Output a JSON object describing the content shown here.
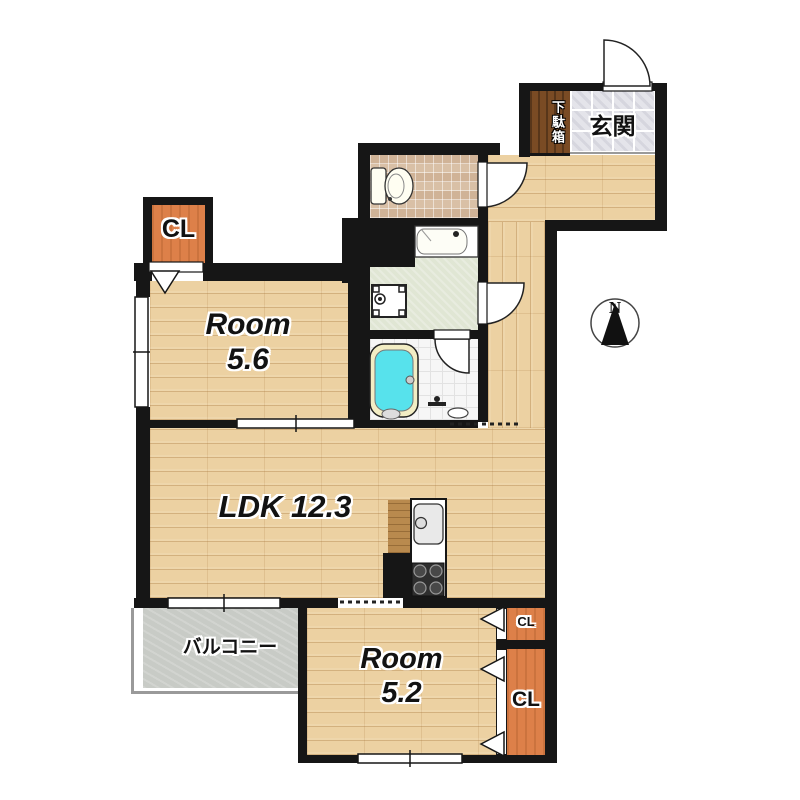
{
  "plan": {
    "rooms": {
      "room_upper": {
        "name": "Room",
        "area": "5.6"
      },
      "ldk": {
        "name": "LDK 12.3"
      },
      "room_lower": {
        "name": "Room",
        "area": "5.2"
      }
    },
    "labels": {
      "entrance": "玄関",
      "shoe_cabinet": "下駄箱",
      "balcony": "バルコニー",
      "closet_upper": "CL",
      "closet_small": "CL",
      "closet_large": "CL",
      "north": "N"
    },
    "colors": {
      "wall": "#161616",
      "wood_floor": "#ecd1a2",
      "closet_fill": "#dd8049",
      "entrance_tile": "#e4e4ea",
      "toilet_tile": "#d9c0a6",
      "washroom_floor": "#e0e6d4",
      "shower_floor": "#f6f6f6",
      "balcony_floor": "#c8cbc6",
      "bathtub_water": "#57e2ec",
      "shoe_cabinet": "#7a4b24"
    }
  }
}
